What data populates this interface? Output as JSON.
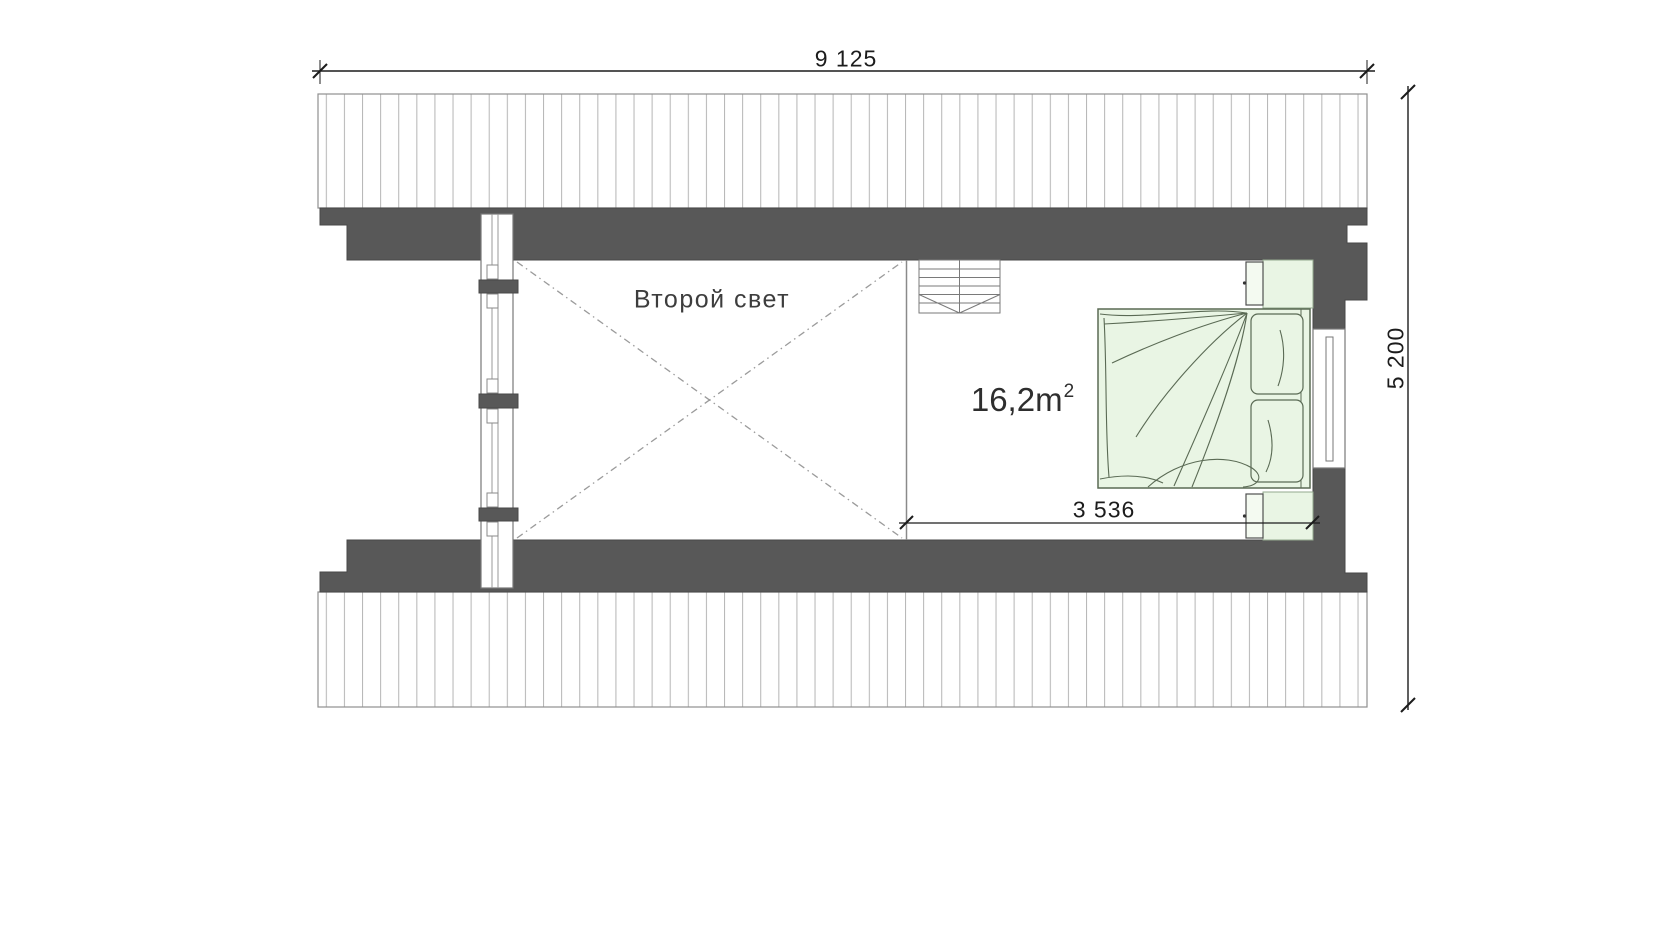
{
  "page": {
    "background": "#ffffff",
    "drawing_type": "attic floor plan"
  },
  "labels": {
    "width_total": "9 125",
    "depth_total": "5 200",
    "bedroom_width": "3 536",
    "void_room": "Второй свет",
    "bedroom_area": "16,2m",
    "bedroom_area_sup": "2"
  },
  "colors": {
    "wall": "#585858",
    "wall_edge": "#474747",
    "hatch_line": "#b8b8b8",
    "hatch_border": "#8f8f8f",
    "furniture_fill": "#e9f5e4",
    "furniture_line": "#5a6a54",
    "nightstand_fill": "#f4faf1",
    "dashed_line": "#9b9b9b",
    "stair_line": "#7a7a7a",
    "dim_ink": "#1c1c1c",
    "label_ink": "#3d3d3d"
  }
}
